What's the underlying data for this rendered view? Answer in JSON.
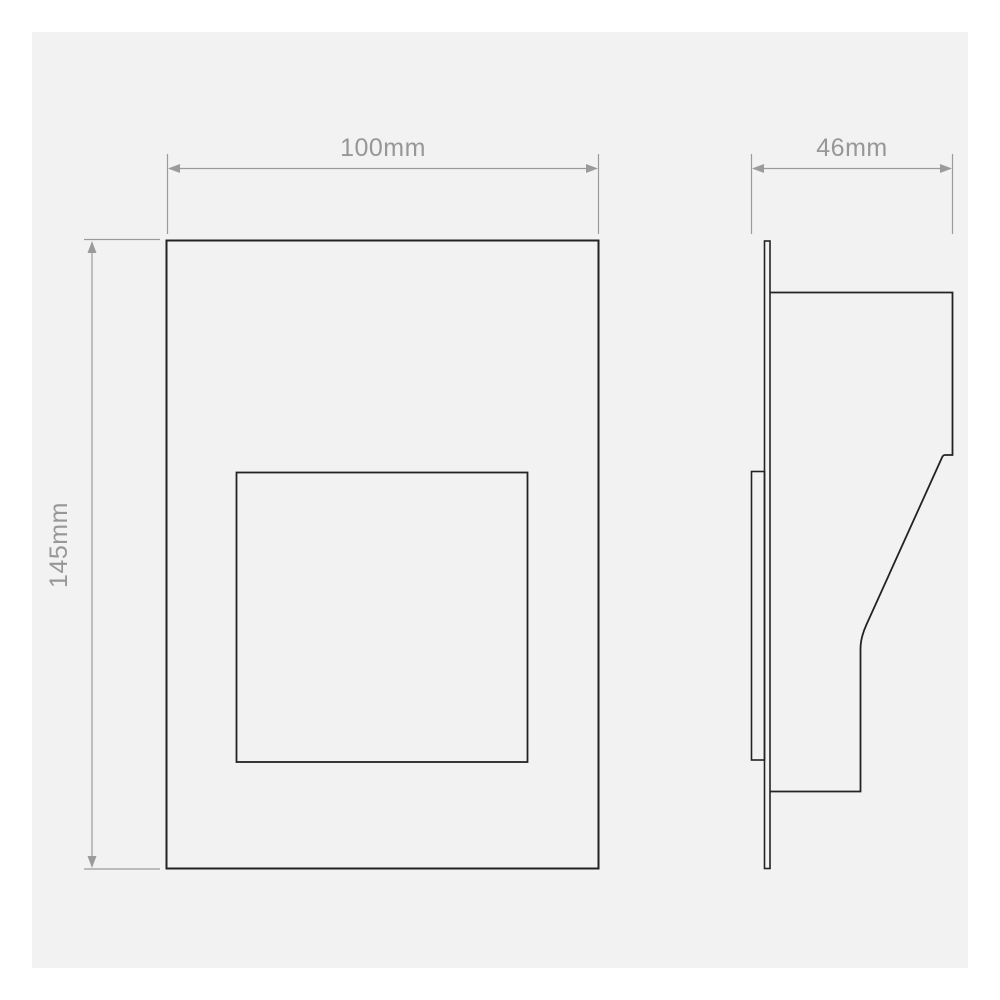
{
  "colors": {
    "page_bg": "#ffffff",
    "panel_bg": "#f2f2f2",
    "outline": "#232323",
    "dimension": "#9b9b9b",
    "label_text": "#979797"
  },
  "drawing": {
    "kind": "technical-dimension-drawing",
    "views": [
      {
        "id": "front-elevation",
        "shapes": [
          "outer-panel",
          "inner-aperture"
        ]
      },
      {
        "id": "side-profile",
        "shapes": [
          "faceplate",
          "recessed-back-box",
          "sloped-body"
        ]
      }
    ],
    "dimensions": [
      {
        "id": "front-width",
        "label": "100mm",
        "orientation": "horizontal"
      },
      {
        "id": "front-height",
        "label": "145mm",
        "orientation": "vertical"
      },
      {
        "id": "side-depth",
        "label": "46mm",
        "orientation": "horizontal"
      }
    ]
  }
}
